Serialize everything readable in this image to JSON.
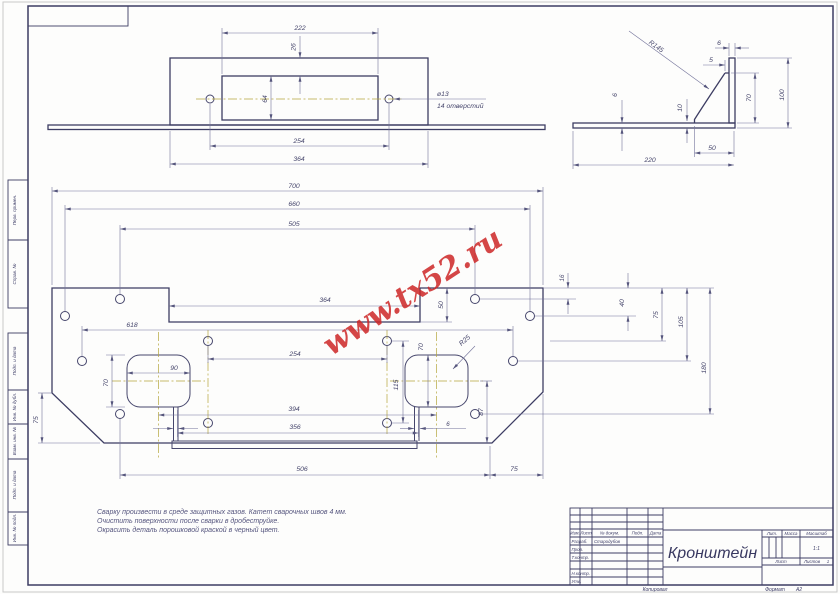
{
  "sheet": {
    "watermark": "www.tx52.ru",
    "kopiroval": "Копировал",
    "format_label": "Формат",
    "format_value": "А2"
  },
  "margin_fields": {
    "perv_primen": "Перв. примен.",
    "sprav_no": "Справ. №",
    "podp_data_1": "Подп. и дата",
    "inv_no_dubl": "Инв. № дубл.",
    "vzam_inv_no": "Взам. инв. №",
    "podp_data_2": "Подп. и дата",
    "inv_no_podl": "Инв. № подл."
  },
  "front_view": {
    "dim_222": "222",
    "dim_26": "26",
    "dim_64": "64",
    "dim_254": "254",
    "dim_364": "364",
    "hole_dia": "ø13",
    "hole_count": "14 отверстий"
  },
  "side_view": {
    "dim_r145": "R145",
    "dim_6_top": "6",
    "dim_5": "5",
    "dim_70": "70",
    "dim_100": "100",
    "dim_6_left": "6",
    "dim_10": "10",
    "dim_50": "50",
    "dim_220": "220"
  },
  "main_view": {
    "dim_700": "700",
    "dim_660": "660",
    "dim_505": "505",
    "dim_364": "364",
    "dim_50": "50",
    "dim_618": "618",
    "dim_254": "254",
    "dim_90": "90",
    "dim_70_left": "70",
    "dim_70_right": "70",
    "dim_115": "115",
    "dim_r25": "R25",
    "dim_394": "394",
    "dim_356": "356",
    "dim_506": "506",
    "dim_75_left": "75",
    "dim_75_bottom": "75",
    "dim_87": "87",
    "dim_6": "6",
    "dim_16": "16",
    "dim_40": "40",
    "dim_75_right": "75",
    "dim_105": "105",
    "dim_180": "180"
  },
  "notes": {
    "line_1": "Сварку произвести в среде защитных газов. Катет сварочных швов 4 мм.",
    "line_2": "Очистить поверхности после сварки в дробеструйке.",
    "line_3": "Окрасить деталь порошковой краской в черный цвет."
  },
  "title_block": {
    "col_izm": "Изм.",
    "col_list": "Лист",
    "col_doc": "№ докум.",
    "col_podp": "Подп.",
    "col_data": "Дата",
    "row_razrab": "Разраб.",
    "razrab_name": "Стародубов",
    "row_prov": "Пров.",
    "row_tkontr": "Т.контр.",
    "row_nkontr": "Н.контр.",
    "row_utv": "Утв.",
    "part_name": "Кронштейн",
    "col_lit": "Лит.",
    "col_massa": "Масса",
    "col_masshtab": "Масштаб",
    "scale": "1:1",
    "list_label": "Лист",
    "listov_label": "Листов",
    "listov_value": "1"
  }
}
